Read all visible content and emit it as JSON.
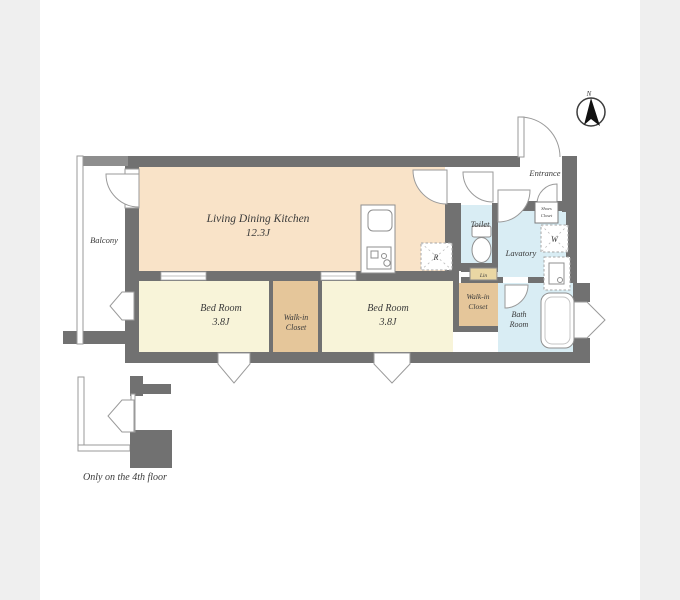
{
  "colors": {
    "page_bg": "#efefef",
    "panel_bg": "#ffffff",
    "wall": "#717171",
    "wall_light": "#8e8e8e",
    "ldk_fill": "#f9e3c8",
    "bedroom_fill": "#f8f4d9",
    "closet_fill": "#e5c69a",
    "wet_fill": "#d9edf4",
    "linen_fill": "#ead7a4",
    "needle": "#111111"
  },
  "labels": {
    "ldk_name": "Living Dining Kitchen",
    "ldk_size": "12.3J",
    "balcony": "Balcony",
    "bedroom1_name": "Bed Room",
    "bedroom1_size": "3.8J",
    "bedroom2_name": "Bed Room",
    "bedroom2_size": "3.8J",
    "wic1_line1": "Walk-in",
    "wic1_line2": "Closet",
    "wic2_line1": "Walk-in",
    "wic2_line2": "Closet",
    "toilet": "Toilet",
    "lavatory": "Lavatory",
    "bath_line1": "Bath",
    "bath_line2": "Room",
    "entrance": "Entrance",
    "shoes_line1": "Shoes",
    "shoes_line2": "Closet",
    "linen": "Lin",
    "washer": "W",
    "refrigerator": "R",
    "compass_north": "N",
    "note": "Only on the 4th floor"
  }
}
